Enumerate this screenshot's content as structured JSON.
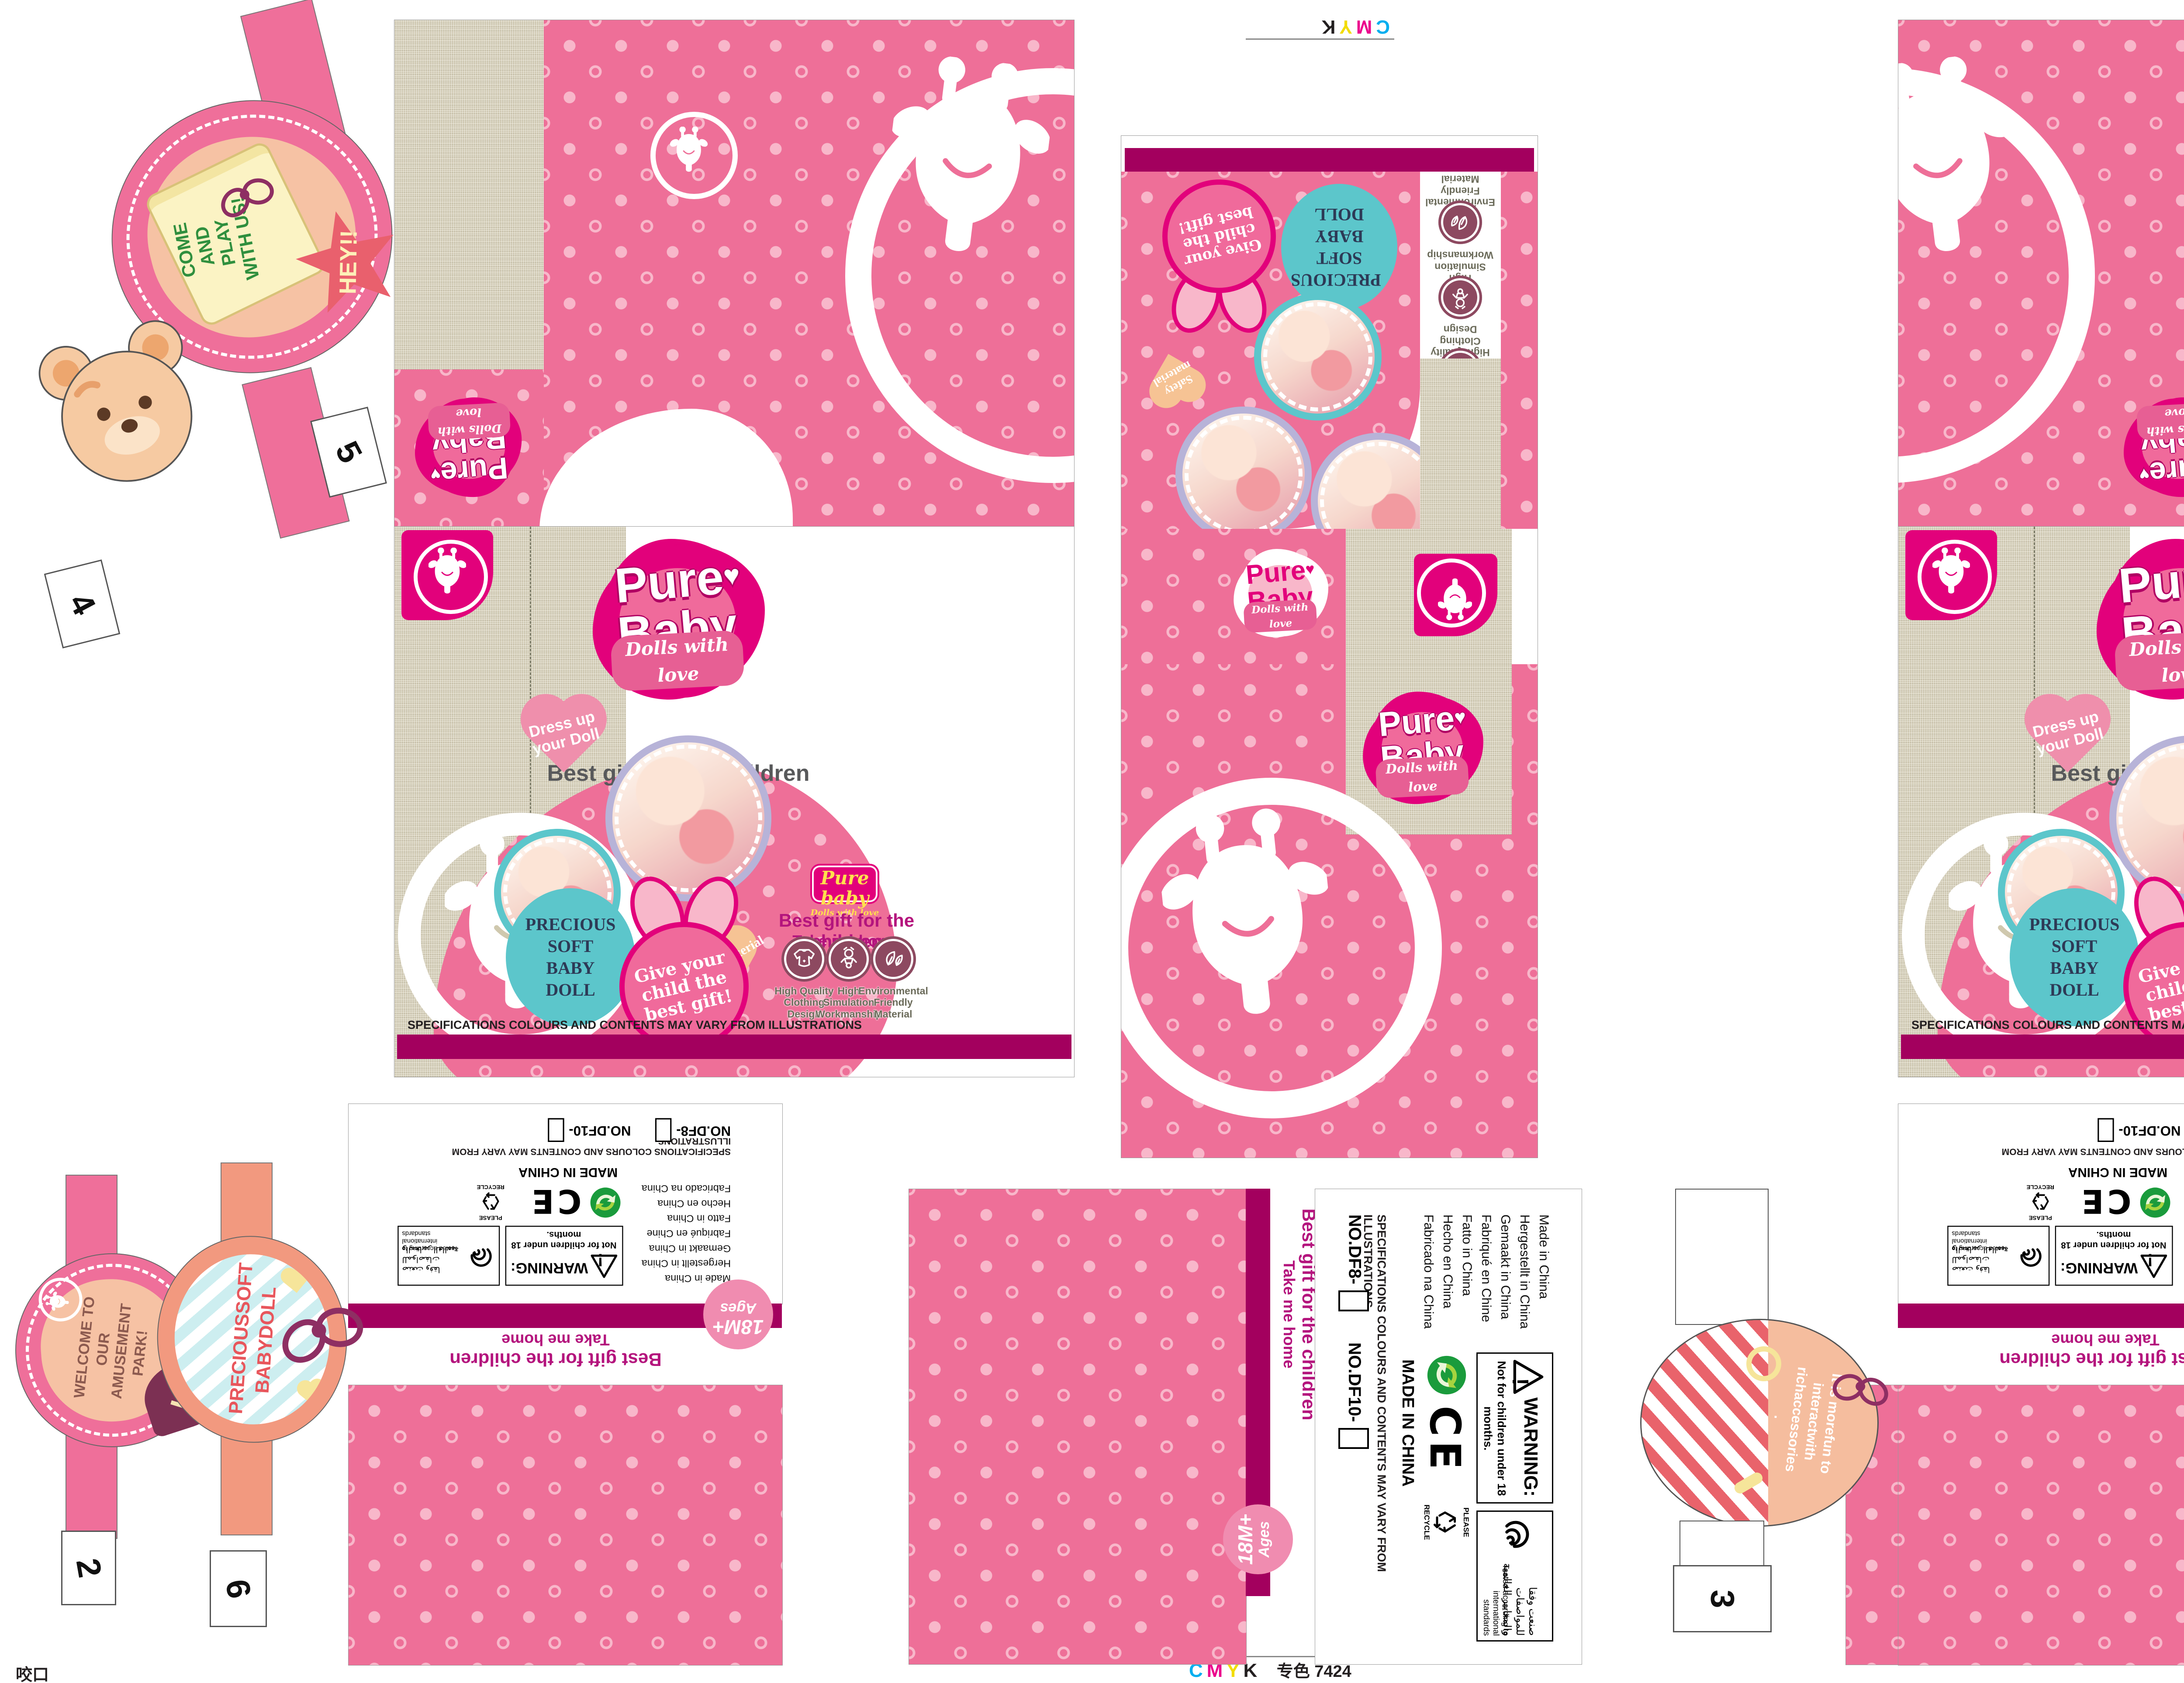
{
  "print": {
    "c": "C",
    "m": "M",
    "y": "Y",
    "k": "K",
    "spot": "专色 7424",
    "file": "DF8  DF10 展示盒 241104",
    "bite": "咬口"
  },
  "brand": {
    "name1": "Pure",
    "name2": "Baby",
    "heart": "♥",
    "tagline": "Dolls with love",
    "badge_name": "Pure baby",
    "badge_tagline": "Dolls with love"
  },
  "panel": {
    "headline": "Best gift for the children",
    "subline": "Take me home",
    "dress_up": "Dress up your Doll",
    "safety": "Safety material",
    "precious": "PRECIOUS SOFT BABY DOLL",
    "give": "Give your child the best gift!",
    "features": [
      {
        "label": "High Quality Clothing Design"
      },
      {
        "label": "High Simulation Workmanship"
      },
      {
        "label": "Environmental Friendly Material"
      }
    ],
    "disclaimer": "SPECIFICATIONS COLOURS AND CONTENTS MAY VARY FROM ILLUSTRATIONS"
  },
  "regulatory": {
    "warning_title": "WARNING:",
    "warning_text": "Not for children under 18 months.",
    "exclaim": "!",
    "tested_ar": "صنعت وفقا للمواصفات والمعايير العالمية",
    "tested_en": "Tested according to international standards",
    "made_in": [
      "Made in China",
      "Hergestellt in China",
      "Gemaakt in China",
      "Fabriqué en Chine",
      "Fatto in China",
      "Hecho en China",
      "Fabricado na China"
    ],
    "made_in_bold": "MADE IN CHINA",
    "ce": "CE",
    "recycle_top": "PLEASE",
    "recycle_bottom": "RECYCLE",
    "no_df8": "NO.DF8-",
    "no_df10": "NO.DF10-",
    "age_line1": "18M+",
    "age_line2": "Ages"
  },
  "tags": {
    "hey": "HEY!!",
    "come_play": "COME AND PLAY WITH US!",
    "wow": "WOW",
    "interact": "It is morefun to interactwith richaccessories .",
    "welcome": "WELCOME TO OUR AMUSEMENT PARK!",
    "hi": "Hi",
    "babydoll": "PRECIOUSSOFT BABYDOLL",
    "numbers": [
      "1",
      "2",
      "3",
      "4",
      "5",
      "6"
    ]
  },
  "colors": {
    "magenta": "#e2017b",
    "pink": "#ee6f98",
    "pink_light": "#f8b7ca",
    "stripe": "#a3005e",
    "teal": "#5cc6cb",
    "beige": "#dad4c0",
    "peach": "#f5b89b",
    "salmon": "#f2997f",
    "cream": "#fbf3c4",
    "green": "#3f9b48",
    "maroon": "#7c3053",
    "red": "#e9636b",
    "gray": "#58595b"
  }
}
